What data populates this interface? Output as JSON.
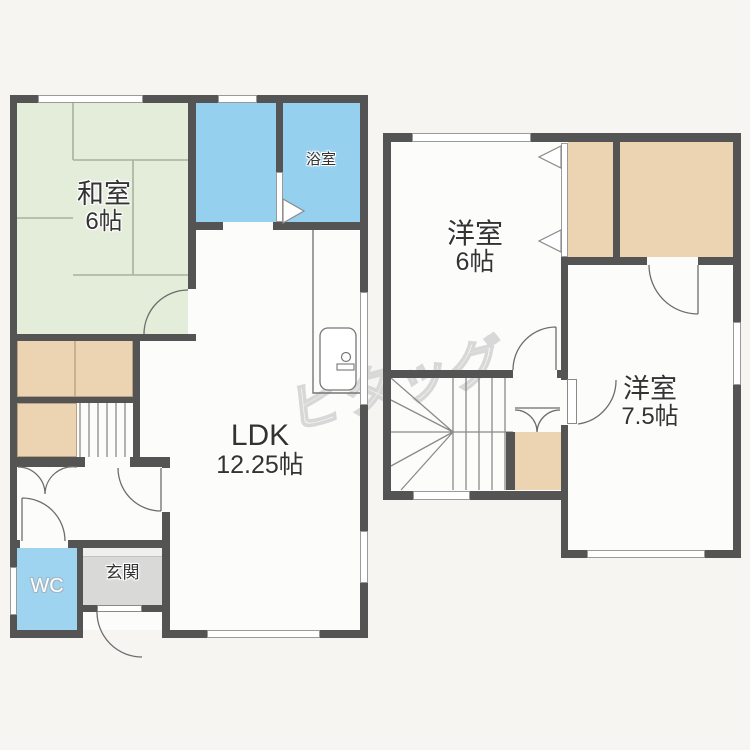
{
  "colors": {
    "bg": "#f6f5f2",
    "wall": "#545454",
    "room": "#fcfcfa",
    "tatami": "#e4ecda",
    "bath": "#96d0ef",
    "wc": "#9fd4f1",
    "closet": "#ecd4b3",
    "genkan": "#d9d9d8",
    "step": "#efefed",
    "text": "#333333",
    "watermark": "#d8d8d8"
  },
  "watermark": {
    "text": "ピタッグ"
  },
  "floor1": {
    "washitsu": {
      "name": "和室",
      "size": "6帖"
    },
    "bath": {
      "name": "浴室"
    },
    "ldk": {
      "name": "LDK",
      "size": "12.25帖"
    },
    "wc": {
      "name": "WC"
    },
    "genkan": {
      "name": "玄関"
    }
  },
  "floor2": {
    "room6": {
      "name": "洋室",
      "size": "6帖"
    },
    "room75": {
      "name": "洋室",
      "size": "7.5帖"
    }
  }
}
